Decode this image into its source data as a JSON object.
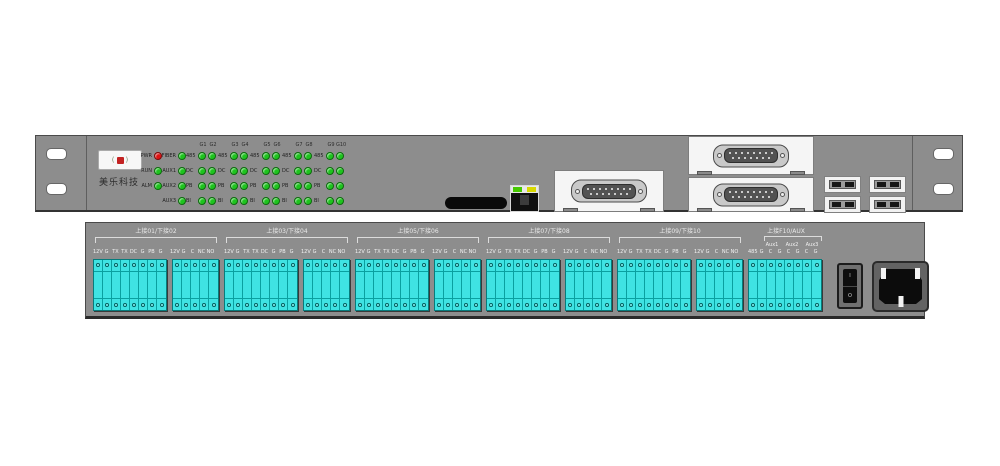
{
  "front_panel": {
    "brand": "美乐科技",
    "status_leds": [
      {
        "label": "PWR",
        "state": "red"
      },
      {
        "label": "RUN",
        "state": "green"
      },
      {
        "label": "ALM",
        "state": "green"
      }
    ],
    "module_leds": [
      {
        "label": "FIBER"
      },
      {
        "label": "AUX1"
      },
      {
        "label": "AUX2"
      },
      {
        "label": "AUX3"
      }
    ],
    "channel_grid": {
      "column_headers": [
        "G1",
        "G2",
        "G3",
        "G4",
        "G5",
        "G6",
        "G7",
        "G8",
        "G9",
        "G10"
      ],
      "row_labels": [
        "485",
        "DC",
        "PB",
        "BI"
      ]
    }
  },
  "back_panel": {
    "groups": [
      {
        "title": "上接01/下接02"
      },
      {
        "title": "上接03/下接04"
      },
      {
        "title": "上接05/下接06"
      },
      {
        "title": "上接07/下接08"
      },
      {
        "title": "上接09/下接10"
      }
    ],
    "terminal_labels_a": [
      "12V",
      "G",
      "TX",
      "TX",
      "DC",
      "G",
      "PB",
      "G"
    ],
    "terminal_labels_b": [
      "12V",
      "G",
      "C",
      "NC",
      "NO"
    ],
    "aux": {
      "title": "上接F10/AUX",
      "sub_labels": [
        "Aux1",
        "Aux2",
        "Aux3"
      ],
      "terminal_labels": [
        "485",
        "G",
        "C",
        "G",
        "C",
        "G",
        "C",
        "G"
      ]
    },
    "power_switch": {
      "on_mark": "I",
      "off_mark": "O"
    }
  },
  "colors": {
    "panel": "#8d8d8d",
    "terminal": "#3fe3e3",
    "led_green": "#1ec41e",
    "led_red": "#e01212"
  }
}
